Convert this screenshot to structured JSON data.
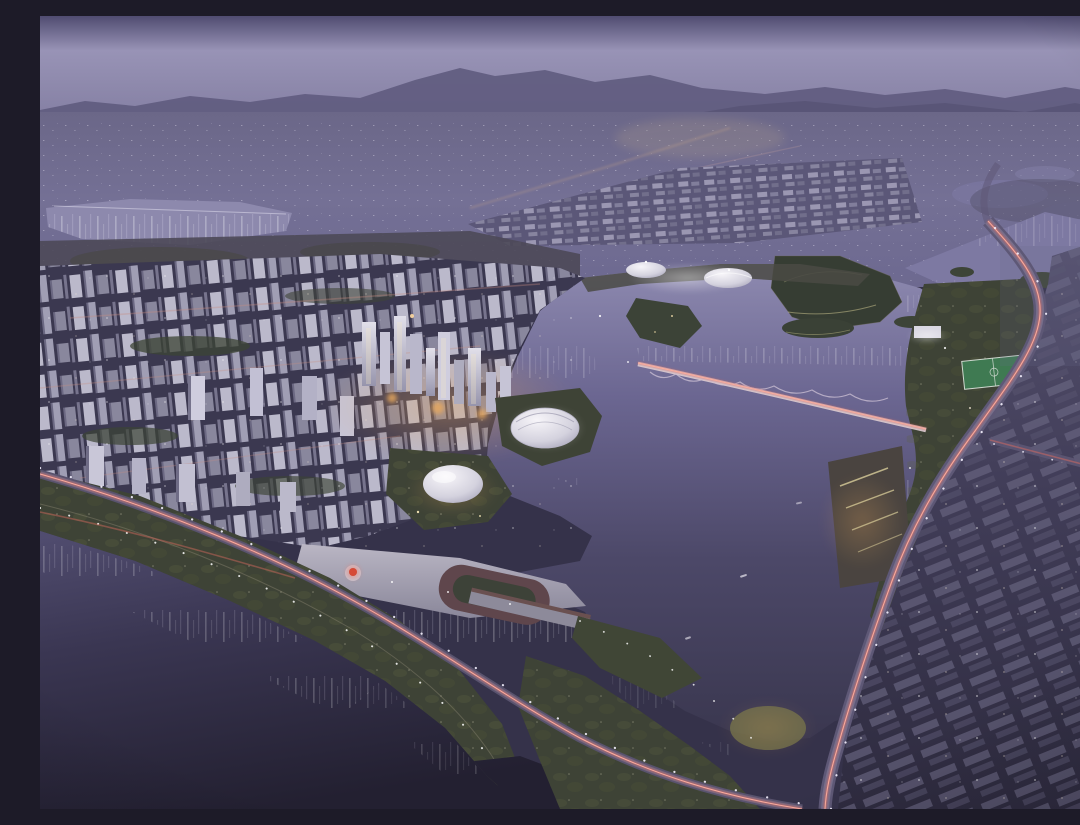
{
  "image": {
    "alt": "Night-time aerial masterplan rendering of a lakeside new town at dusk: dense illuminated city blocks on the left, a central business district with glowing towers, a large dark lake with wooded islands, a wavy pedestrian bridge, a curving arterial road with red car-light trails on the right, a waterfront boulevard and river along the lower left, and hazy mountains on the horizon",
    "type": "architectural-rendering",
    "time_of_day": "dusk"
  },
  "palette": {
    "sky-top": "#504c71",
    "sky-haze": "#9893b6",
    "mountain": "#5f5b7e",
    "plain": "#6e6a8a",
    "water-far": "#8d89ad",
    "lake-top": "#8e8ab0",
    "lake-mid": "#6b6691",
    "lake-deep": "#3a374f",
    "river-deep": "#232031",
    "city-light": "#e2e0ea",
    "city-mid": "#a9a7bd",
    "city-shadow": "#55516c",
    "ground-dark": "#3b3850",
    "park-green": "#3e4336",
    "park-lit": "#7c7a4e",
    "trail-red": "#d96a60",
    "trail-red-bright": "#ffb0a0",
    "warm-glow": "#e8a95e",
    "pitch-green": "#3f7a52",
    "sculpture-red": "#c0392b",
    "street-light": "#f5f2ff"
  },
  "scene": {
    "regions": [
      {
        "name": "sky",
        "description": "hazy violet dusk sky"
      },
      {
        "name": "mountains",
        "description": "layered mountain silhouettes on horizon"
      },
      {
        "name": "distant-city",
        "description": "speckled far-away city lights on valley plain"
      },
      {
        "name": "far-lake",
        "description": "distant reflective lake with mast lights, upper left"
      },
      {
        "name": "ne-grid-district",
        "description": "grid of lit mid-rise blocks, upper middle-right"
      },
      {
        "name": "west-city",
        "description": "dense white residential towers on left half"
      },
      {
        "name": "cbd",
        "description": "tall glowing office towers with warm base lights"
      },
      {
        "name": "lake",
        "description": "large central lake with light reflections"
      },
      {
        "name": "islands",
        "description": "wooded islands with lit trails"
      },
      {
        "name": "wavy-bridge",
        "description": "undulating bridge with red light trail crossing lake"
      },
      {
        "name": "dome-hall",
        "description": "white egg-shaped venue on lit lakeside peninsula"
      },
      {
        "name": "shell-stadium",
        "description": "white shell-roofed arena by the lake"
      },
      {
        "name": "plaza-pier",
        "description": "civic plaza with red sculpture and pier into the water"
      },
      {
        "name": "waterfront-boulevard",
        "description": "riverside boulevard with red car-light trails"
      },
      {
        "name": "river",
        "description": "dark river along lower left with shore reflections"
      },
      {
        "name": "east-highway",
        "description": "curving arterial with red trails and street lights"
      },
      {
        "name": "east-district",
        "description": "dark low-rise slab district, right side"
      },
      {
        "name": "sports-pitch",
        "description": "green floodlit pitch in lakeside park"
      }
    ]
  }
}
